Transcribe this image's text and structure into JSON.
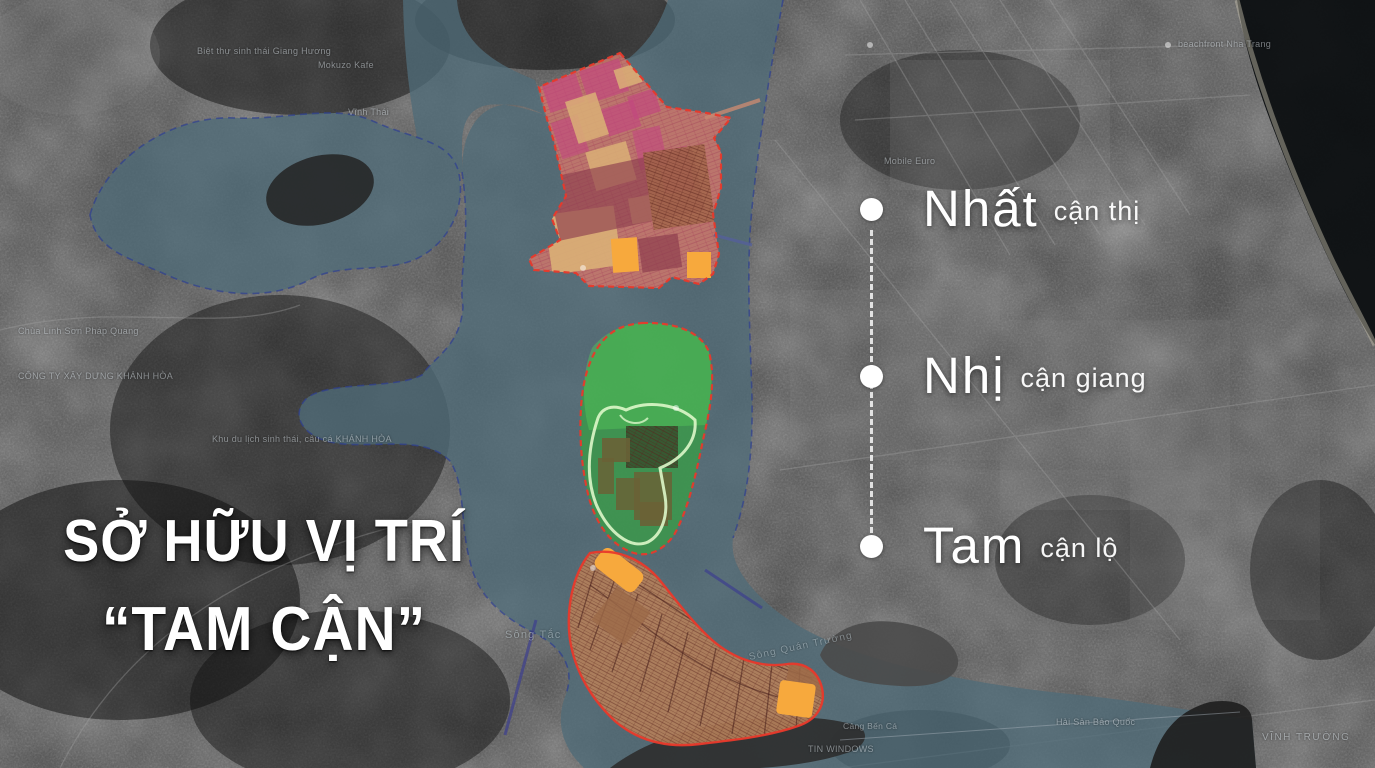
{
  "title": {
    "line1": "SỞ HỮU VỊ TRÍ",
    "line2": "“TAM CẬN”"
  },
  "benefits": {
    "items": [
      {
        "rank": "Nhất",
        "detail": "cận thị"
      },
      {
        "rank": "Nhị",
        "detail": "cận giang"
      },
      {
        "rank": "Tam",
        "detail": "cận lộ"
      }
    ]
  },
  "map_labels": {
    "giang_huong": "Biệt thự sinh thái Giang Hương",
    "mokuzo_kafe": "Mokuzo Kafe",
    "vinh_thai": "Vĩnh Thái",
    "beachfront": "beachfront Nha Trang",
    "mobile_euro": "Mobile Euro",
    "chua_linh_son": "Chùa Linh Sơn Pháp Quang",
    "cong_ty_xay_dung": "CÔNG TY XÂY DỰNG KHÁNH HÒA",
    "khu_du_lich": "Khu du lịch sinh thái, câu cá KHÁNH HÒA",
    "song_tac": "Sông Tắc",
    "song_quan_truong": "Sông Quán Trường",
    "cang_ben_ca": "Cảng Bến Cá",
    "tin_windows": "TIN WINDOWS",
    "hai_san_bao_quoc": "Hải Sản Bảo Quốc",
    "vinh_truong": "VĨNH TRƯỜNG"
  },
  "colors": {
    "water_overlay": "#4f6b78",
    "zone_urban": "#c9766b",
    "zone_green": "#3a9a49",
    "zone_crescent": "#b5805a",
    "zone_border": "#e8392b",
    "accent_orange": "#f7a93d",
    "text_white": "#ffffff"
  }
}
